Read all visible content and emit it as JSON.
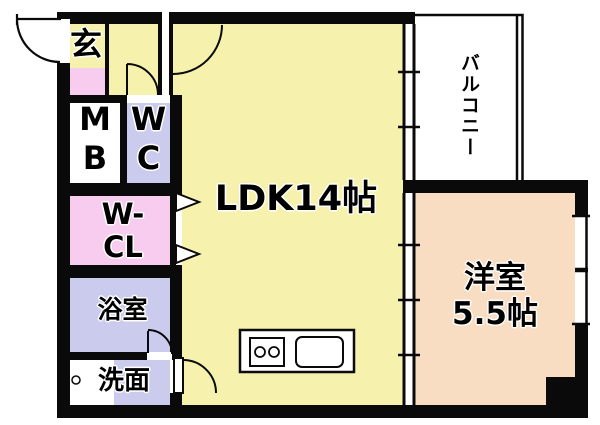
{
  "floorplan": {
    "rooms": {
      "genkan": {
        "label": "玄"
      },
      "meter_box": {
        "line1": "M",
        "line2": "B"
      },
      "toilet": {
        "line1": "W",
        "line2": "C"
      },
      "walk_in_closet": {
        "line1": "W-",
        "line2": "CL"
      },
      "bathroom": {
        "label": "浴室"
      },
      "washroom": {
        "label": "洗面"
      },
      "ldk": {
        "label": "LDK14帖"
      },
      "balcony": {
        "label": "バルコニー"
      },
      "western_room": {
        "line1": "洋室",
        "line2": "5.5帖"
      }
    },
    "colors": {
      "room_yellow": "#F6F2AE",
      "room_pink": "#F8CCEF",
      "room_lavender": "#CBCBEE",
      "room_peach": "#F9DDC2",
      "wall_black": "#0A0A0A",
      "fixture_white": "#FFFFFF"
    }
  }
}
